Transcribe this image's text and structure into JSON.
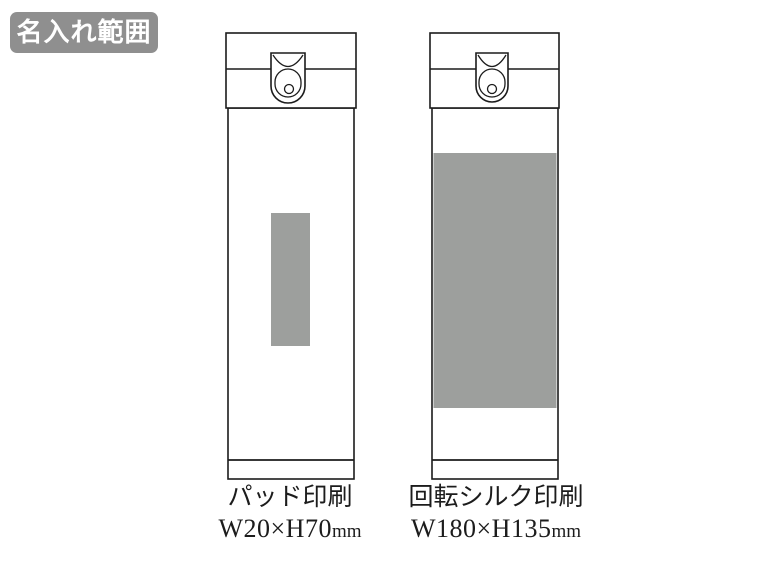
{
  "badge": {
    "label": "名入れ範囲",
    "bg_color": "#8f8f8f",
    "text_color": "#ffffff"
  },
  "colors": {
    "background": "#ffffff",
    "outline": "#1c1c1c",
    "print_area_fill": "#9d9f9d"
  },
  "bottles": [
    {
      "name": "pad-print-bottle",
      "print_method": "パッド印刷",
      "print_area": {
        "label": "W20×H70",
        "unit": "mm",
        "width_mm": 20,
        "height_mm": 70
      }
    },
    {
      "name": "rotary-silk-print-bottle",
      "print_method": "回転シルク印刷",
      "print_area": {
        "label": "W180×H135",
        "unit": "mm",
        "width_mm": 180,
        "height_mm": 135
      }
    }
  ]
}
